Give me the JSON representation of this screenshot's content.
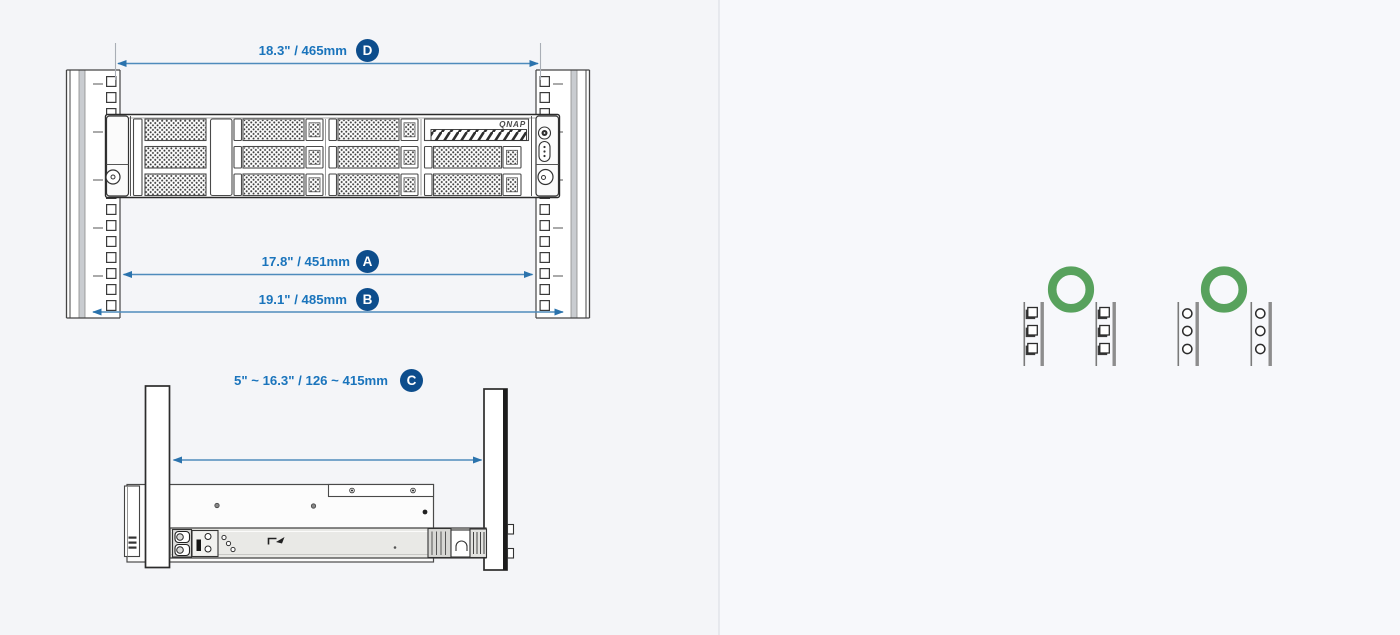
{
  "front_view": {
    "brand_logo": "QNAP",
    "dimensions": {
      "d": {
        "letter": "D",
        "value": "18.3\" / 465mm"
      },
      "a": {
        "letter": "A",
        "value": "17.8\" / 451mm"
      },
      "b": {
        "letter": "B",
        "value": "19.1\" / 485mm"
      }
    }
  },
  "side_view": {
    "dimensions": {
      "c": {
        "letter": "C",
        "value": "5\" ~ 16.3\" / 126 ~ 415mm"
      }
    }
  },
  "rack_compatibility": {
    "square_hole": {
      "icon": "green-circle-compatible-icon"
    },
    "round_hole": {
      "icon": "green-circle-compatible-icon"
    }
  },
  "colors": {
    "dimension_text": "#1a74bc",
    "dimension_line": "#4e8bbc",
    "badge_fill": "#0d4d8c",
    "badge_text": "#ffffff",
    "compatible_green": "#58a25d",
    "drawing_outline": "#3b3b3b",
    "background_left": "#f4f5f8",
    "background_right": "#f7f8fb"
  }
}
